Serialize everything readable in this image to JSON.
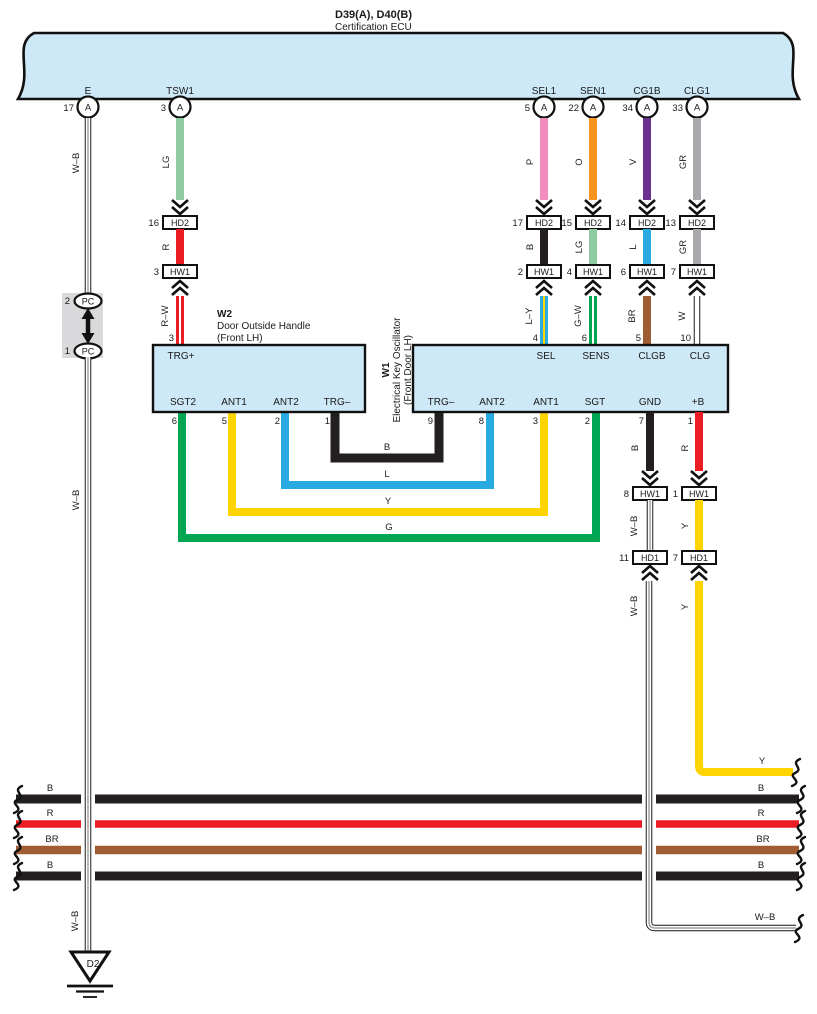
{
  "colors": {
    "band_fill": "#CDE8F6",
    "black_wire": "#231F20",
    "red": "#EC1C24",
    "light_green": "#8FCBA1",
    "pink": "#F28CBD",
    "orange": "#F7941E",
    "violet": "#6B3191",
    "gray": "#A7A9AC",
    "blue": "#29ABE2",
    "yellow": "#FFD400",
    "green": "#00A651",
    "brown": "#A05C33"
  },
  "header": {
    "code": "D39(A), D40(B)",
    "name": "Certification ECU"
  },
  "ecu_pins": {
    "e": {
      "label": "E",
      "pin": "17",
      "conn": "A"
    },
    "tsw1": {
      "label": "TSW1",
      "pin": "3",
      "conn": "A"
    },
    "sel1": {
      "label": "SEL1",
      "pin": "5",
      "conn": "A"
    },
    "sen1": {
      "label": "SEN1",
      "pin": "22",
      "conn": "A"
    },
    "cg1b": {
      "label": "CG1B",
      "pin": "34",
      "conn": "A"
    },
    "clg1": {
      "label": "CLG1",
      "pin": "33",
      "conn": "A"
    }
  },
  "left_branch": {
    "wire": "W–B",
    "pc_top_pin": "2",
    "pc_top_label": "PC",
    "pc_bot_pin": "1",
    "pc_bot_label": "PC",
    "ground_id": "D2"
  },
  "branches": {
    "tsw1": {
      "wire_top": "LG",
      "hd2_pin": "16",
      "hd2": "HD2",
      "wire_mid": "R",
      "hw1_pin": "3",
      "hw1": "HW1",
      "wire_low": "R–W"
    },
    "sel1": {
      "wire_top": "P",
      "hd2_pin": "17",
      "hd2": "HD2",
      "wire_mid": "B",
      "hw1_pin": "2",
      "hw1": "HW1",
      "wire_low": "L–Y"
    },
    "sen1": {
      "wire_top": "O",
      "hd2_pin": "15",
      "hd2": "HD2",
      "wire_mid": "LG",
      "hw1_pin": "4",
      "hw1": "HW1",
      "wire_low": "G–W"
    },
    "cg1b": {
      "wire_top": "V",
      "hd2_pin": "14",
      "hd2": "HD2",
      "wire_mid": "L",
      "hw1_pin": "6",
      "hw1": "HW1",
      "wire_low": "BR"
    },
    "clg1": {
      "wire_top": "GR",
      "hd2_pin": "13",
      "hd2": "HD2",
      "wire_mid": "GR",
      "hw1_pin": "7",
      "hw1": "HW1",
      "wire_low": "W"
    }
  },
  "w2": {
    "id": "W2",
    "name_line1": "Door Outside Handle",
    "name_line2": "(Front LH)",
    "pin_top": {
      "label": "TRG+",
      "num": "3"
    },
    "pins_bottom": {
      "sgt2": {
        "label": "SGT2",
        "num": "6"
      },
      "ant1": {
        "label": "ANT1",
        "num": "5"
      },
      "ant2": {
        "label": "ANT2",
        "num": "2"
      },
      "trg_minus": {
        "label": "TRG–",
        "num": "1"
      }
    }
  },
  "w1": {
    "id": "W1",
    "name_line1": "Electrical Key Oscillator",
    "name_line2": "(Front Door LH)",
    "pins_top": {
      "sel": {
        "label": "SEL",
        "num": "4"
      },
      "sens": {
        "label": "SENS",
        "num": "6"
      },
      "clgb": {
        "label": "CLGB",
        "num": "5"
      },
      "clg": {
        "label": "CLG",
        "num": "10"
      }
    },
    "pins_bottom": {
      "trg_minus": {
        "label": "TRG–",
        "num": "9"
      },
      "ant2": {
        "label": "ANT2",
        "num": "8"
      },
      "ant1": {
        "label": "ANT1",
        "num": "3"
      },
      "sgt": {
        "label": "SGT",
        "num": "2"
      },
      "gnd": {
        "label": "GND",
        "num": "7"
      },
      "plus_b": {
        "label": "+B",
        "num": "1"
      }
    }
  },
  "loops": {
    "b": "B",
    "l": "L",
    "y": "Y",
    "g": "G"
  },
  "gnd_branch": {
    "wire_top": "B",
    "hw1_pin": "8",
    "hw1": "HW1",
    "wire_mid": "W–B",
    "hd1_pin": "11",
    "hd1": "HD1",
    "wire_low": "W–B",
    "wire_low_h": "W–B"
  },
  "plus_b_branch": {
    "wire_top": "R",
    "hw1_pin": "1",
    "hw1": "HW1",
    "wire_mid": "Y",
    "hd1_pin": "7",
    "hd1": "HD1",
    "wire_low": "Y",
    "wire_low_h": "Y"
  },
  "bus_wires": [
    {
      "left": "B",
      "right": "B"
    },
    {
      "left": "R",
      "right": "R"
    },
    {
      "left": "BR",
      "right": "BR"
    },
    {
      "left": "B",
      "right": "B"
    }
  ]
}
